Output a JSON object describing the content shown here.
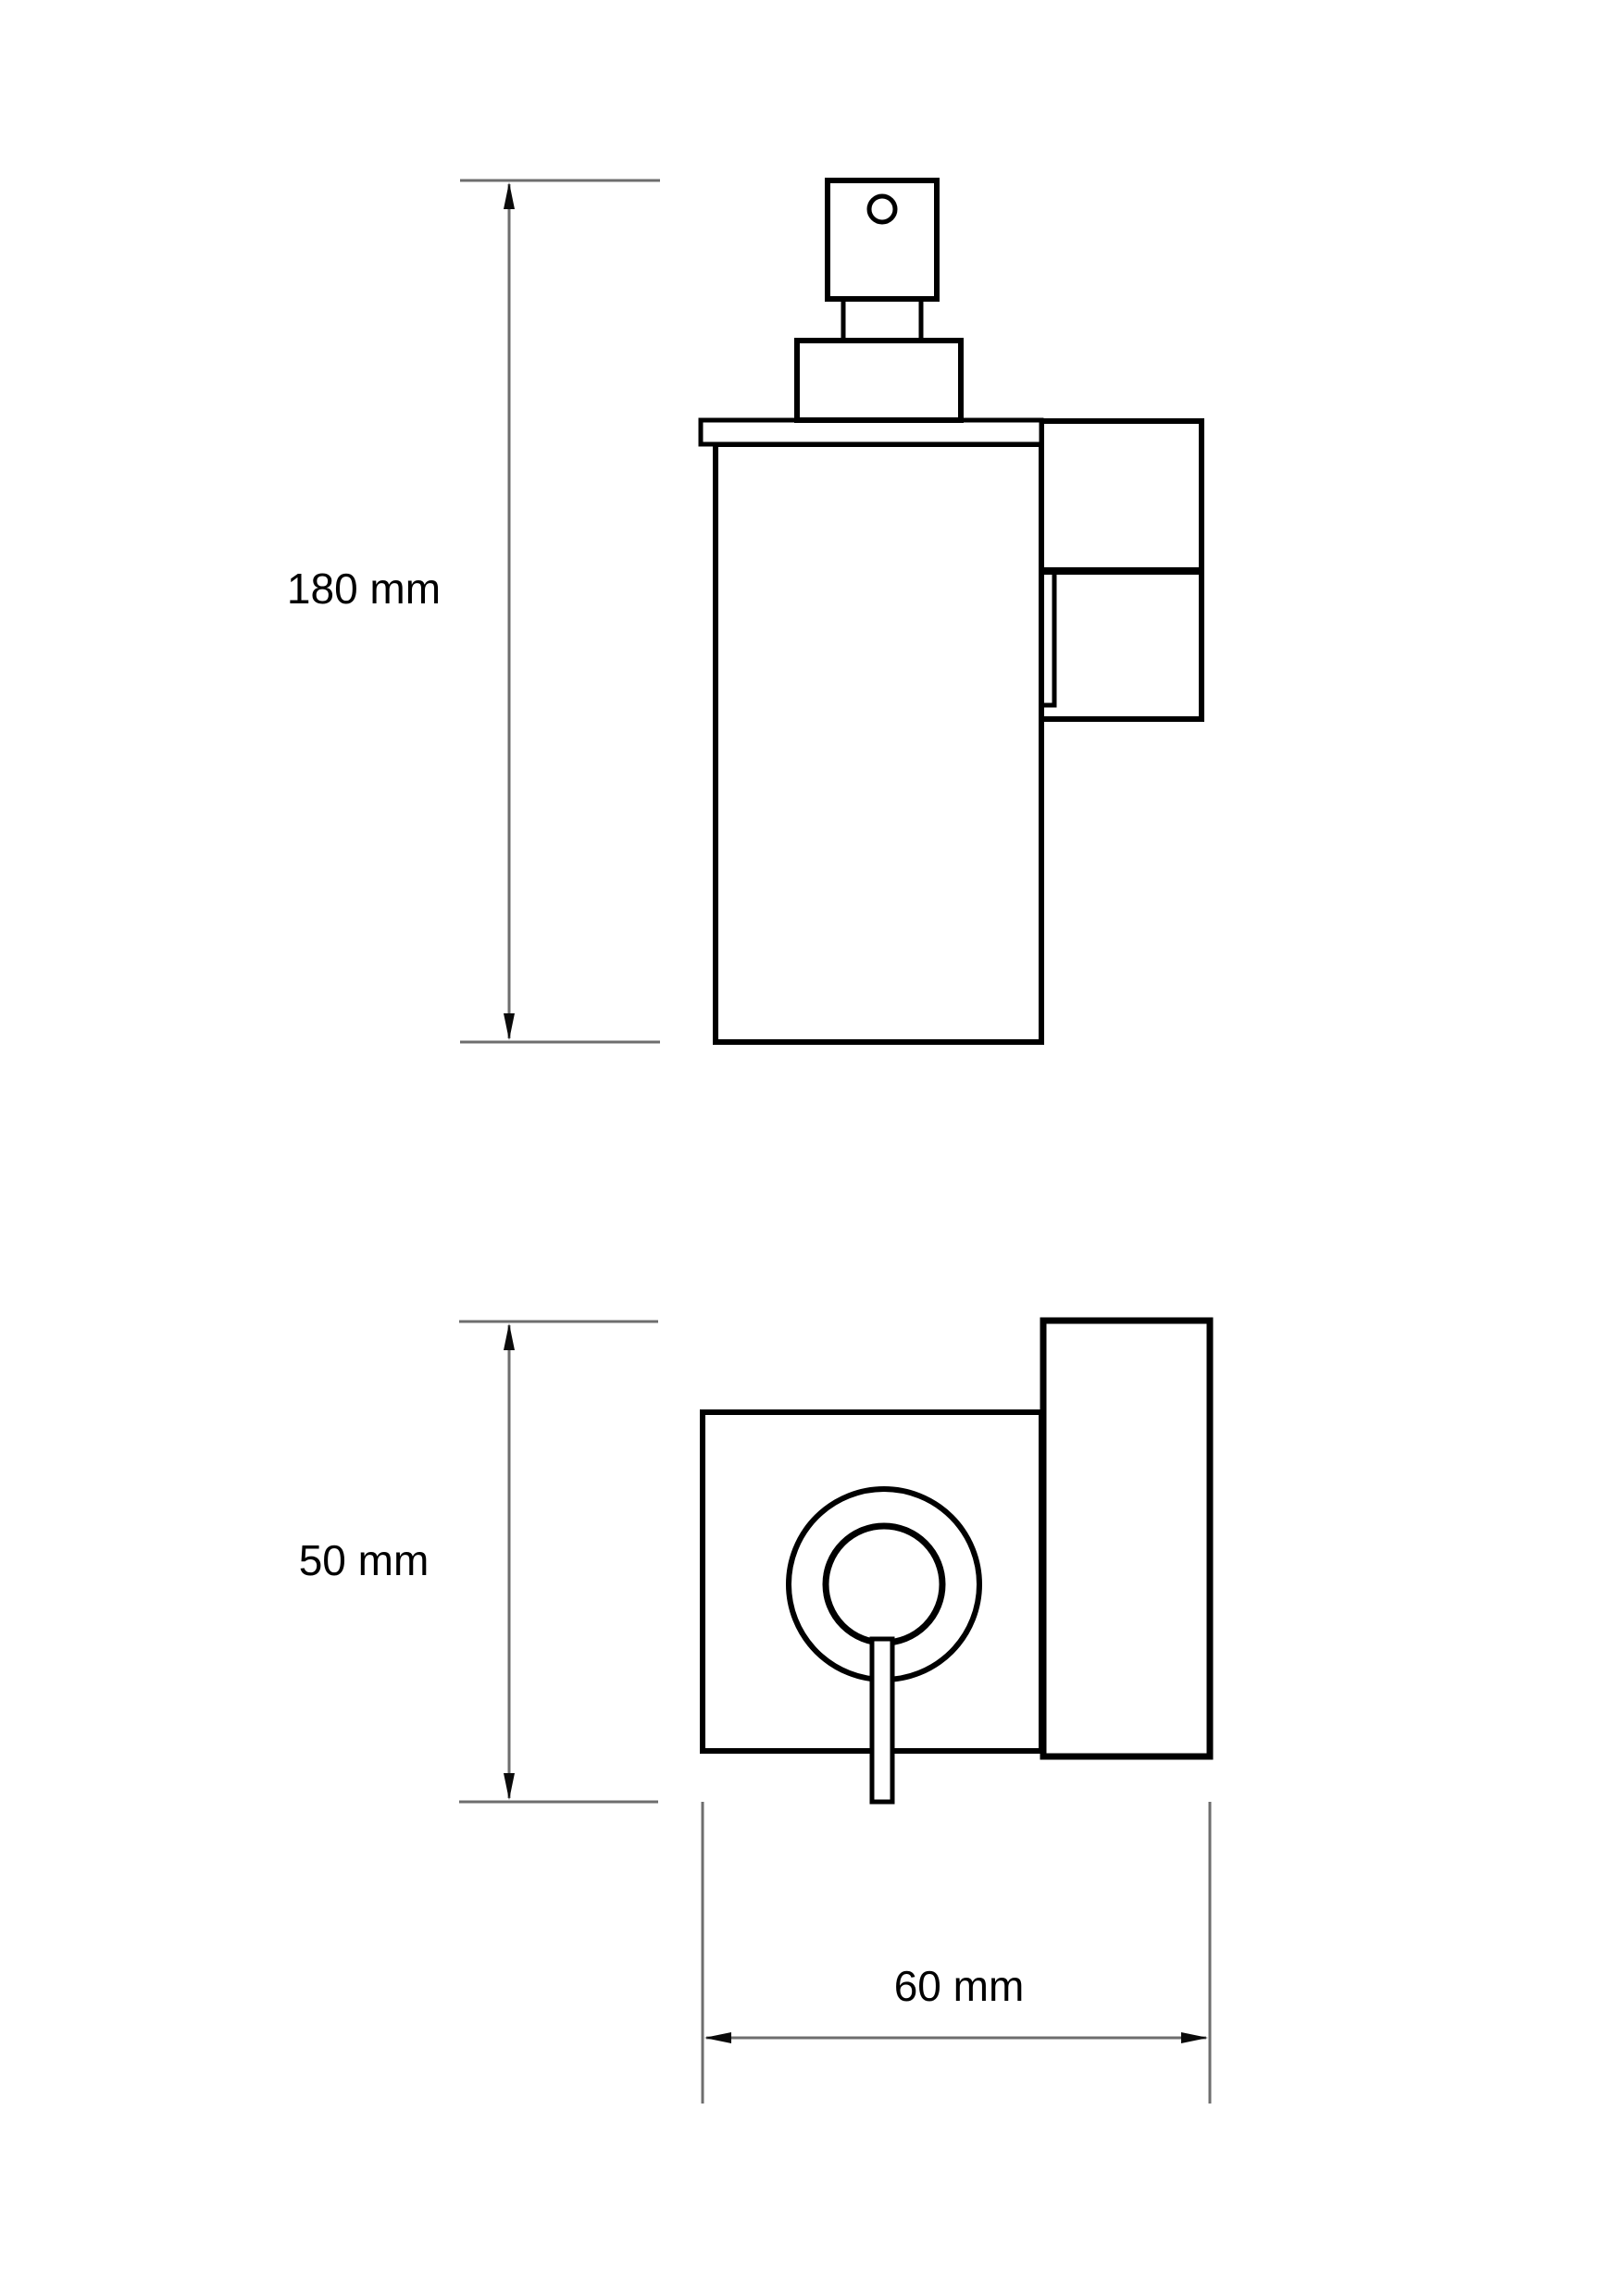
{
  "page": {
    "type": "technical-drawing",
    "background": "#ffffff"
  },
  "colors": {
    "outline": "#000000",
    "dimension_line": "#6e6e6e",
    "arrowhead": "#0a0a0a",
    "text": "#000000"
  },
  "views": {
    "side": {
      "name": "side-elevation-soap-dispenser"
    },
    "plan": {
      "name": "top-view-soap-dispenser"
    }
  },
  "dimensions": {
    "height": {
      "label": "180 mm"
    },
    "depth": {
      "label": "50 mm"
    },
    "width": {
      "label": "60 mm"
    }
  }
}
